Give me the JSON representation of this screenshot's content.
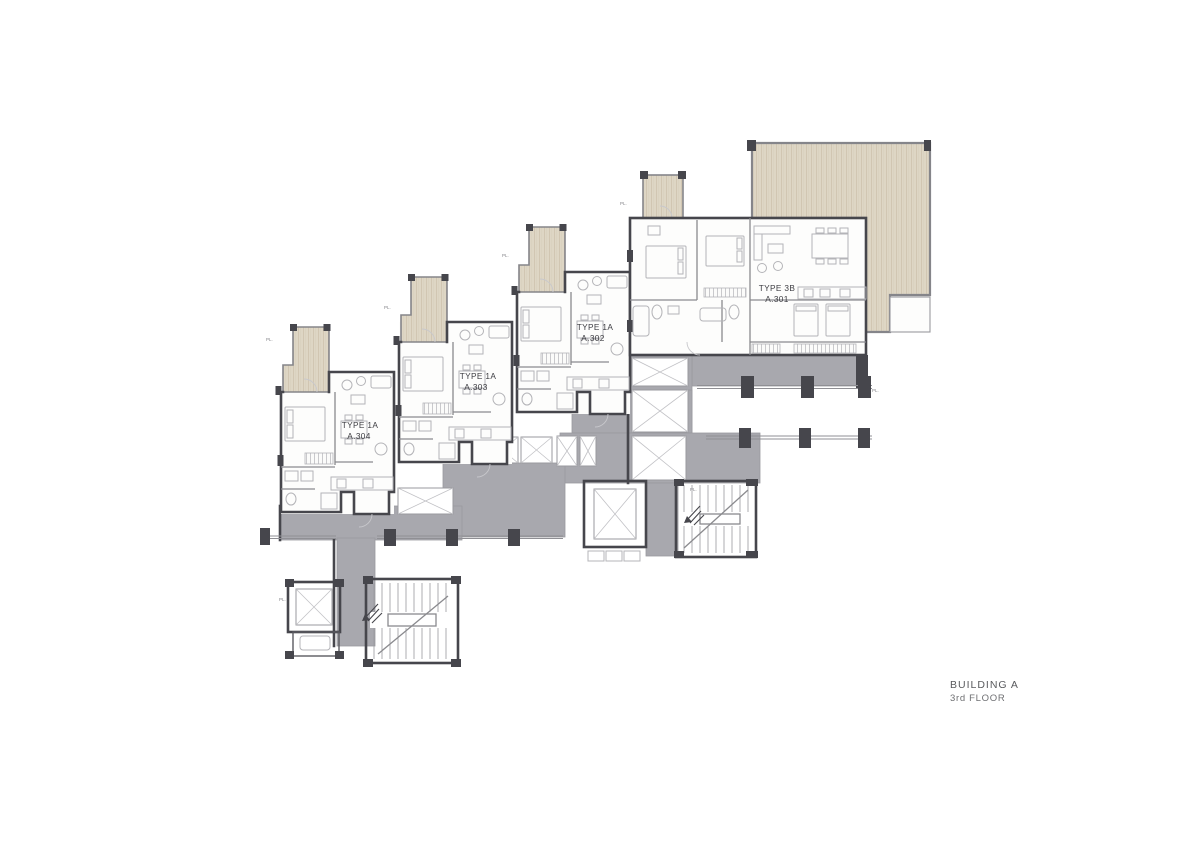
{
  "drawing": {
    "building_label": "BUILDING A",
    "floor_label": "3rd FLOOR"
  },
  "units": [
    {
      "id": "A301",
      "type_label": "TYPE 3B",
      "unit_number": "A.301"
    },
    {
      "id": "A302",
      "type_label": "TYPE 1A",
      "unit_number": "A.302"
    },
    {
      "id": "A303",
      "type_label": "TYPE 1A",
      "unit_number": "A.303"
    },
    {
      "id": "A304",
      "type_label": "TYPE 1A",
      "unit_number": "A.304"
    }
  ],
  "annotations": {
    "property_line_mark": "PL."
  },
  "colors": {
    "corridor_fill": "#a8a8ae",
    "wall_dark": "#46464c",
    "terrace_fill": "#ded6c5",
    "terrace_grain": "#cec3ae",
    "interior_line": "#8a8a8e",
    "furniture_line": "#b4b4b8",
    "unit_label_text": "#3d3d42",
    "title_text": "#595a5d",
    "paper": "#ffffff"
  }
}
